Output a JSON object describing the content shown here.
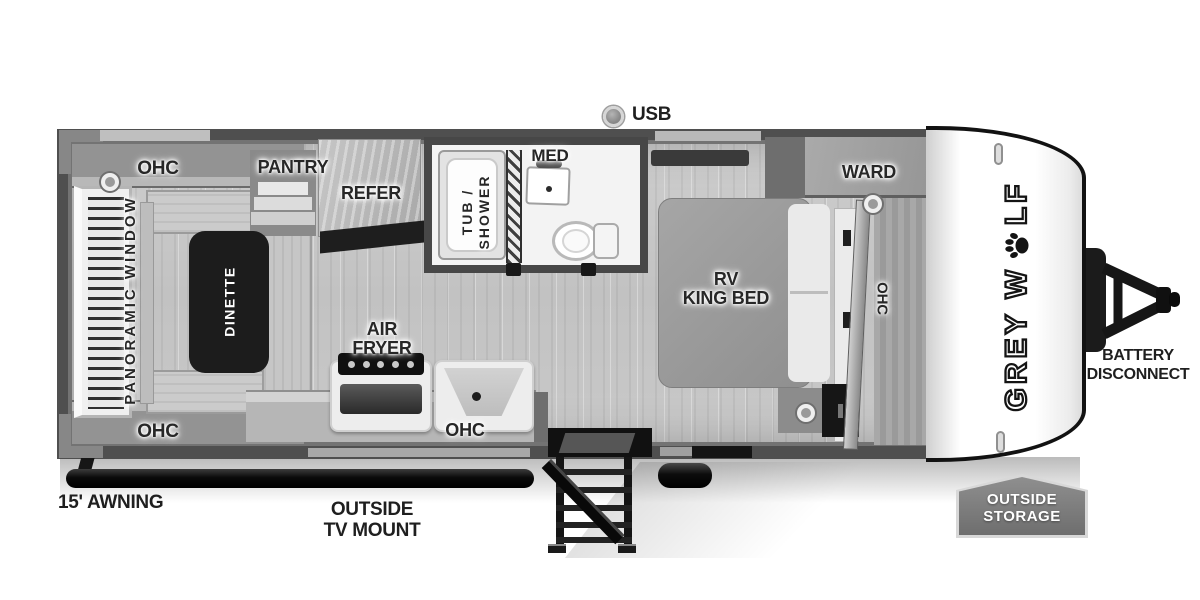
{
  "palette": {
    "wall": "#4f4f4f",
    "floor": "#c8c8c8",
    "fixture_black": "#141414",
    "badge_gray": "#767676"
  },
  "callouts": {
    "usb": "USB",
    "awning": "15' AWNING",
    "tv_mount_line1": "OUTSIDE",
    "tv_mount_line2": "TV MOUNT",
    "battery_line1": "BATTERY",
    "battery_line2": "DISCONNECT",
    "storage_line1": "OUTSIDE",
    "storage_line2": "STORAGE"
  },
  "brand": {
    "part1": "GREY W",
    "part2": "LF"
  },
  "rooms": {
    "rear_ohc_top": "OHC",
    "rear_ohc_bottom": "OHC",
    "panoramic_window": "PANORAMIC WINDOW",
    "dinette": "DINETTE",
    "pantry": "PANTRY",
    "refer": "REFER",
    "tub_line1": "TUB /",
    "tub_line2": "SHOWER",
    "med": "MED",
    "air_line1": "AIR",
    "air_line2": "FRYER",
    "kitchen_ohc": "OHC",
    "bed_line1": "RV",
    "bed_line2": "KING BED",
    "ward": "WARD",
    "bedroom_ohc": "OHC"
  }
}
